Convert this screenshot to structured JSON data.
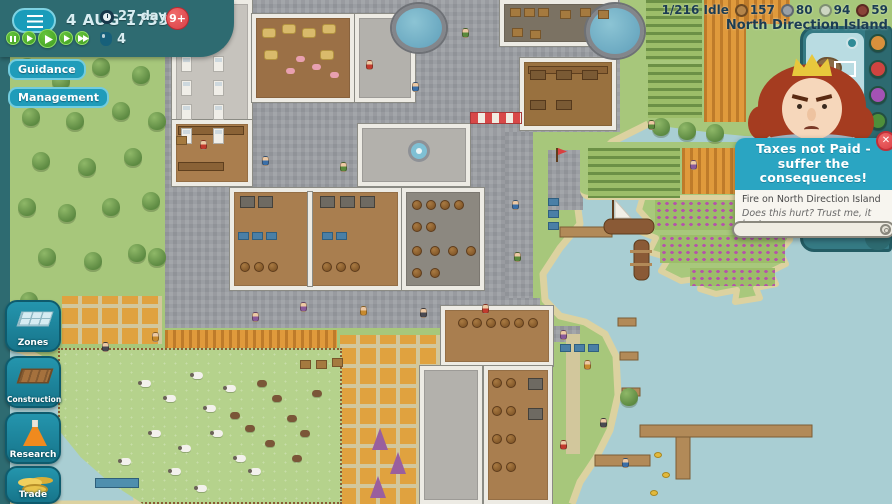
{
  "hud": {
    "top_left": {
      "date": "4 AUG 1733",
      "day_counter": "27 days",
      "notification_badge": "9+",
      "ink_count": "4",
      "speed_controls": [
        "pause",
        "play-slow",
        "play",
        "play-fast",
        "play-fastest"
      ]
    },
    "top_right": {
      "idle": "1/216 Idle",
      "resources": [
        {
          "name": "coconuts",
          "value": "157",
          "color": "#b5854a",
          "border": "#6e4a22"
        },
        {
          "name": "stone",
          "value": "80",
          "color": "#9aa0a6",
          "border": "#606870"
        },
        {
          "name": "planks",
          "value": "94",
          "color": "#cdd6c2",
          "border": "#7e8f72"
        },
        {
          "name": "bricks",
          "value": "59",
          "color": "#8a4438",
          "border": "#5c2a22"
        }
      ],
      "island_name": "North Direction Island"
    },
    "side_buttons": {
      "guidance": "Guidance",
      "management": "Management"
    },
    "dock_buttons": [
      {
        "id": "zones",
        "label": "Zones"
      },
      {
        "id": "construction",
        "label": "Construction"
      },
      {
        "id": "research",
        "label": "Research"
      },
      {
        "id": "trade",
        "label": "Trade"
      }
    ],
    "notification": {
      "title": "Taxes not Paid - suffer the consequences!",
      "event": "Fire on North Direction Island",
      "quote": "Does this hurt? Trust me, it hurts me even more.",
      "close_label": "✕"
    },
    "minimap": {
      "filter_icons": [
        "wheat",
        "apple",
        "grapes",
        "leaf",
        "cotton",
        "stone",
        "coal",
        "herb"
      ]
    }
  },
  "colors": {
    "panel_teal": "#2e6b71",
    "button_teal": "#1f9cba",
    "speed_green": "#4aad27",
    "alert_red": "#e8474f",
    "bubble_teal": "#2aa5c2",
    "water": "#a9ced3",
    "grass": "#a7c77b",
    "sand": "#dcd2a0"
  }
}
